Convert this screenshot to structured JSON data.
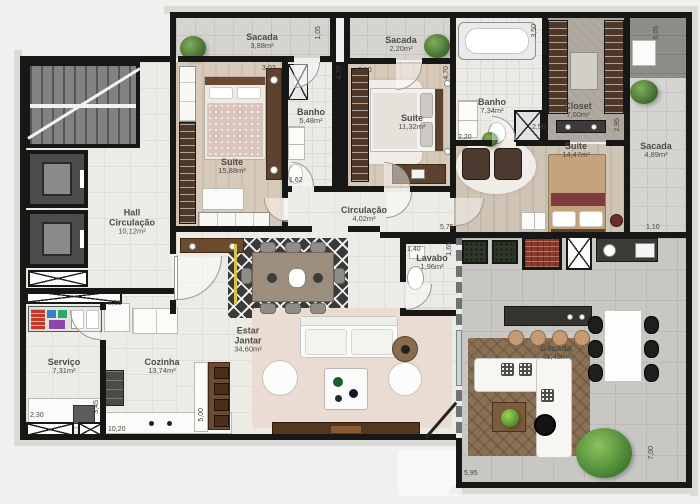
{
  "plan_title": "apartment-floor-plan",
  "rooms": {
    "sacada_388": {
      "name": "Sacada",
      "area": "3,88m²"
    },
    "suite_1588": {
      "name": "Suite",
      "area": "15,88m²"
    },
    "banho_548": {
      "name": "Banho",
      "area": "5,48m²"
    },
    "hall": {
      "name": "Hall",
      "name2": "Circulação",
      "area": "10,12m²"
    },
    "sacada_220": {
      "name": "Sacada",
      "area": "2,20m²"
    },
    "suite_1132": {
      "name": "Suite",
      "area": "11,32m²"
    },
    "banho_734": {
      "name": "Banho",
      "area": "7,34m²"
    },
    "closet_700": {
      "name": "Closet",
      "area": "7,00m²"
    },
    "suite_1447": {
      "name": "Suite",
      "area": "14,47m²"
    },
    "sacada_489": {
      "name": "Sacada",
      "area": "4,89m²"
    },
    "circulacao": {
      "name": "Circulação",
      "area": "4,02m²"
    },
    "lavabo": {
      "name": "Lavabo",
      "area": "1,96m²"
    },
    "estar": {
      "name": "Estar",
      "name2": "Jantar",
      "area": "34,60m²"
    },
    "cozinha": {
      "name": "Cozinha",
      "area": "13,74m²"
    },
    "servico": {
      "name": "Serviço",
      "area": "7,31m²"
    },
    "sacada_4145": {
      "name": "Sacada",
      "area": "41,45m²"
    }
  },
  "dims": {
    "sacada388_depth": "1,05",
    "suite1588_width": "3,02",
    "suite1132_width": "3,10",
    "suite1132_left": "4,70",
    "suite1132_right": "4,70",
    "banho734_height": "3,50",
    "banho734_width": "2,20",
    "closet_left": "2,50",
    "closet_right": "2,95",
    "sacada489_height": "6,05",
    "banho548_width": "1,62",
    "circulacao_width": "5,75",
    "sacada489_bottom": "1,10",
    "lavabo_width": "1,40",
    "lavabo_height": "1,65",
    "hall_wall": "2,15",
    "servico_width": "2,30",
    "servico_height": "3,45",
    "apartment_width": "10,20",
    "kitchen_height": "5,00",
    "sacada4145_width": "5,95",
    "sacada4145_height": "7,00"
  },
  "colors": {
    "wall": "#171716",
    "wood_floor": "#d8cabb",
    "tile_floor": "#edebe6",
    "balcony_floor": "#c8c7c4",
    "brick": "#8a3a2b",
    "plant_green": "#4f7a38",
    "rug_dark": "#3a3a39",
    "rug_brown": "#8a7054"
  }
}
